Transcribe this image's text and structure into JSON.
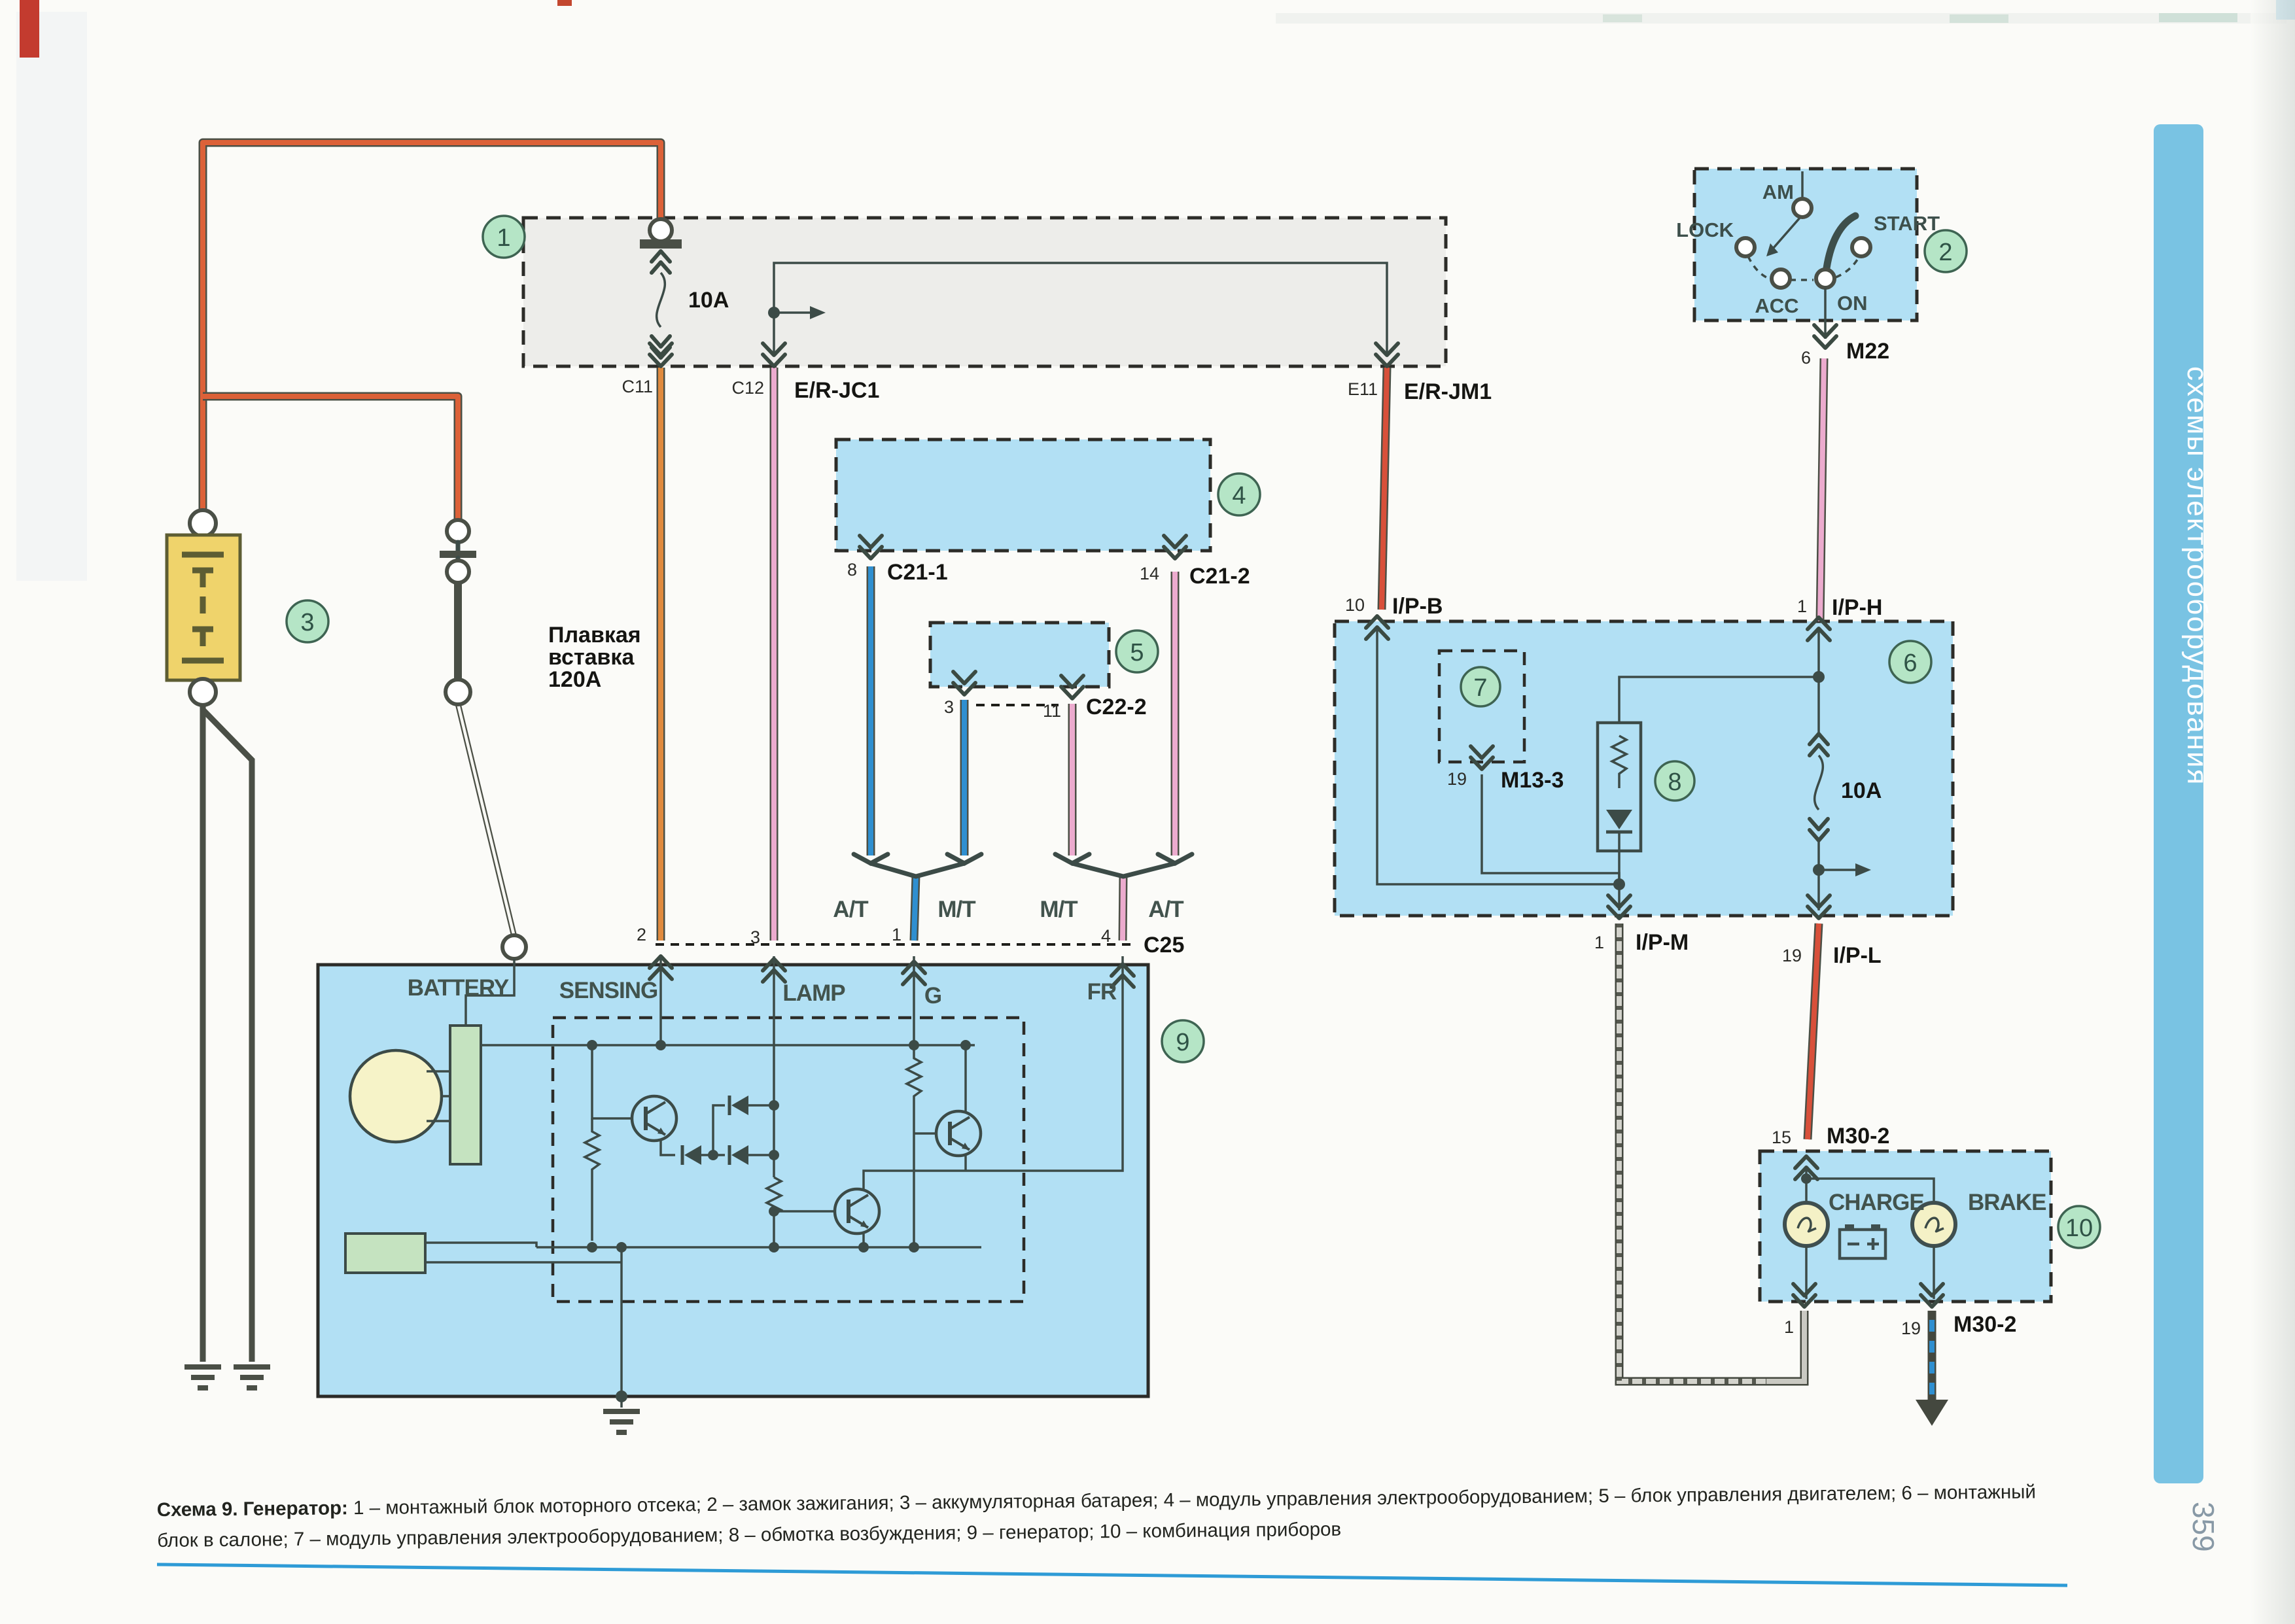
{
  "page": {
    "caption_lead": "Схема 9. Генератор:",
    "caption_text": " 1 – монтажный блок моторного отсека; 2 – замок зажигания; 3 – аккумуляторная батарея; 4 – модуль управления электрооборудованием; 5 – блок управления двигателем; 6 – монтажный блок в салоне; 7 – модуль управления электрооборудованием; 8 – обмотка возбуждения; 9 – генератор; 10 – комбинация приборов",
    "sidebar": "схемы электрооборудования",
    "page_number": "359"
  },
  "colors": {
    "block_fill": "#b2e0f4",
    "wire_orange": "#e08a3e",
    "wire_orange_red": "#dc6138",
    "wire_pink": "#ecabce",
    "wire_red": "#d8503a",
    "wire_blue": "#2f8fd0",
    "callout_green": "#b5e5c6",
    "sidebar_blue": "#79c3e3",
    "battery_yellow": "#efd36b"
  },
  "junction_engine": {
    "callout": "1",
    "fuse": "10A",
    "c11": "C11",
    "c12": "C12",
    "e11": "E11",
    "erjc1": "E/R-JC1",
    "erjm1": "E/R-JM1"
  },
  "ignition": {
    "callout": "2",
    "am": "AM",
    "lock": "LOCK",
    "acc": "ACC",
    "on": "ON",
    "start": "START",
    "pin": "6",
    "conn": "M22"
  },
  "battery": {
    "callout": "3",
    "link1": "Плавкая",
    "link2": "вставка",
    "link3": "120А"
  },
  "module4": {
    "callout": "4",
    "pin8": "8",
    "c21_1": "C21-1",
    "pin14": "14",
    "c21_2": "C21-2"
  },
  "module5": {
    "callout": "5",
    "pin3": "3",
    "pin11": "11",
    "c22_2": "C22-2"
  },
  "trans": {
    "at1": "A/T",
    "mt1": "M/T",
    "mt2": "M/T",
    "at2": "A/T"
  },
  "generator": {
    "callout": "9",
    "conn": "C25",
    "battery": "BATTERY",
    "sensing": "SENSING",
    "lamp": "LAMP",
    "g": "G",
    "fr": "FR",
    "pin2": "2",
    "pin3": "3",
    "pin1": "1",
    "pin4": "4"
  },
  "junction_cabin": {
    "callout": "6",
    "callout7": "7",
    "callout8": "8",
    "fuse": "10A",
    "pin10": "10",
    "ipb": "I/P-B",
    "pin1h": "1",
    "iph": "I/P-H",
    "pin19m": "19",
    "m13": "M13-3",
    "pin1m": "1",
    "ipm": "I/P-M",
    "pin19l": "19",
    "ipl": "I/P-L"
  },
  "cluster": {
    "callout": "10",
    "pin15": "15",
    "m30_top": "M30-2",
    "charge": "CHARGE",
    "brake": "BRAKE",
    "pin1": "1",
    "pin19": "19",
    "m30_bottom": "M30-2"
  }
}
